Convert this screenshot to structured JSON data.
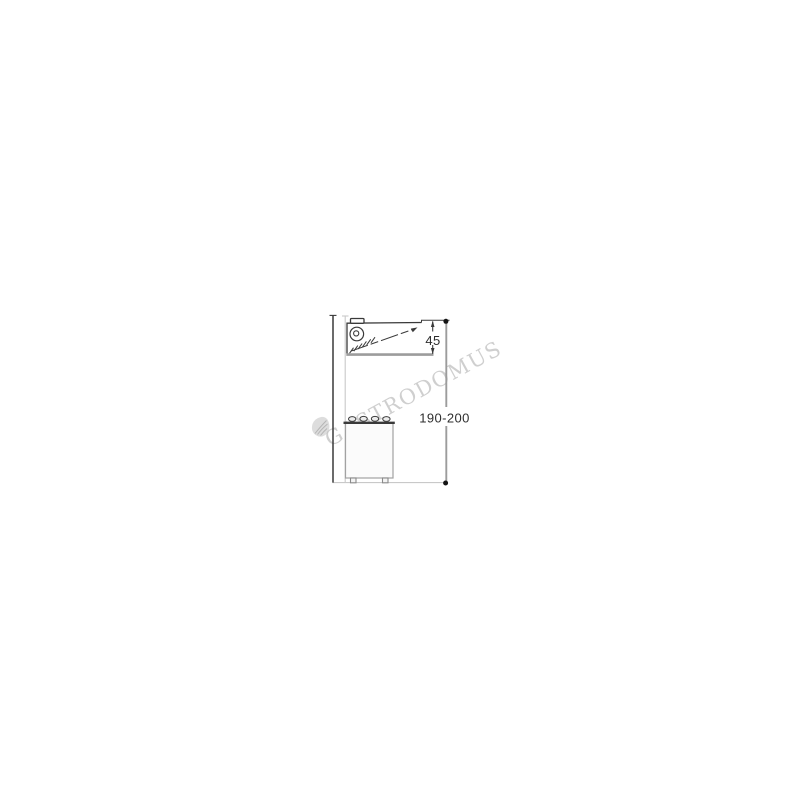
{
  "drawing": {
    "dimension_labels": {
      "hood_height": "45",
      "installation_height": "190-200"
    },
    "watermark": "GASTRODOMUS"
  },
  "colors": {
    "background": "#ffffff",
    "line_dark": "#3a3a3a",
    "line_medium_gray": "#9c9c9c",
    "line_light_gray": "#c9c9c9",
    "dimension_text": "#2e2e2e",
    "watermark": "#b3b3b3",
    "leaf_fill": "#d2d2d2",
    "leaf_stroke": "#aeaeae"
  }
}
